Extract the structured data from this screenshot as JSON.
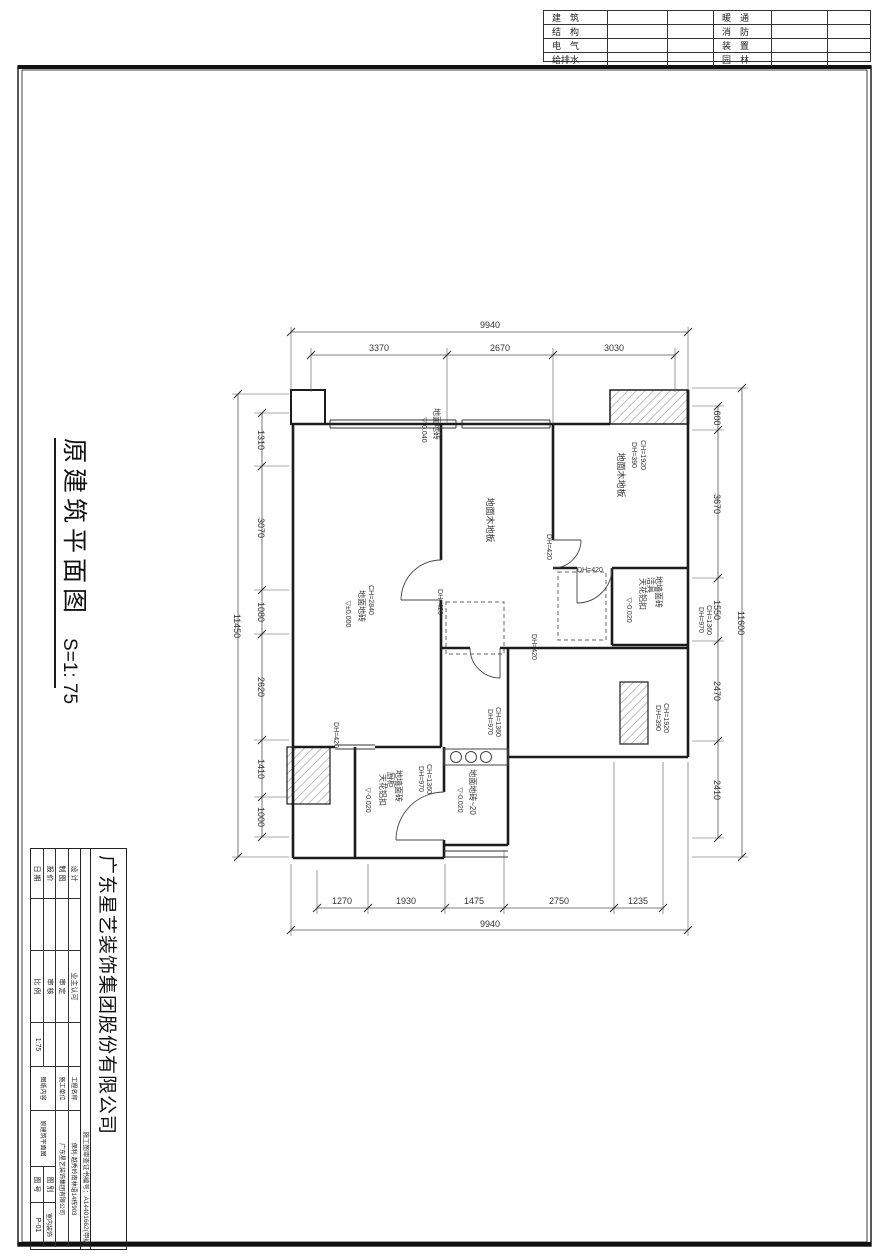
{
  "sheet_title": {
    "name": "原建筑平面图",
    "scale": "S=1: 75"
  },
  "discipline_table": {
    "rows": [
      {
        "left": "建　筑",
        "right": "暖　通"
      },
      {
        "left": "结　构",
        "right": "消　防"
      },
      {
        "left": "电　气",
        "right": "装　置"
      },
      {
        "left": "给排水",
        "right": "园　林"
      }
    ]
  },
  "title_block": {
    "company": "广东星艺装饰集团股份有限公司",
    "cert_no": "施工图审查证书编号：A14401662(甲级)",
    "approval": {
      "design_label": "设 计",
      "draft_label": "制 图",
      "quote_label": "报 价",
      "date_label": "日 期",
      "owner_label": "业主认可",
      "approve_label": "审 定",
      "review_label": "审 核",
      "scale_label": "比 例",
      "scale_value": "1:75"
    },
    "project": {
      "name_label": "工程名称",
      "name_value": "保利·越秀岭南林语14栋903",
      "builder_label": "施工单位",
      "builder_value": "广东星艺装饰集团有限公司",
      "content_label": "图纸内容",
      "content_value": "原建筑平面图",
      "category_label": "图 别",
      "category_value": "室内装饰",
      "number_label": "图 号",
      "number_value": "P-01"
    }
  },
  "plan": {
    "dim_texts": [
      {
        "t": "9940",
        "x": 490,
        "y": 328,
        "r": 0,
        "s": 9,
        "n": "dim-top-total"
      },
      {
        "t": "3370",
        "x": 379,
        "y": 351,
        "r": 0,
        "s": 9,
        "n": "dim-top"
      },
      {
        "t": "2670",
        "x": 500,
        "y": 351,
        "r": 0,
        "s": 9,
        "n": "dim-top"
      },
      {
        "t": "3030",
        "x": 614,
        "y": 351,
        "r": 0,
        "s": 9,
        "n": "dim-top"
      },
      {
        "t": "1270",
        "x": 342,
        "y": 904,
        "r": 0,
        "s": 9,
        "n": "dim-bottom"
      },
      {
        "t": "1930",
        "x": 406,
        "y": 904,
        "r": 0,
        "s": 9,
        "n": "dim-bottom"
      },
      {
        "t": "1475",
        "x": 474,
        "y": 904,
        "r": 0,
        "s": 9,
        "n": "dim-bottom"
      },
      {
        "t": "2750",
        "x": 559,
        "y": 904,
        "r": 0,
        "s": 9,
        "n": "dim-bottom"
      },
      {
        "t": "1235",
        "x": 638,
        "y": 904,
        "r": 0,
        "s": 9,
        "n": "dim-bottom"
      },
      {
        "t": "9940",
        "x": 490,
        "y": 927,
        "r": 0,
        "s": 9,
        "n": "dim-bottom-total"
      },
      {
        "t": "1310",
        "x": 258,
        "y": 440,
        "r": 90,
        "s": 9,
        "n": "dim-left"
      },
      {
        "t": "3070",
        "x": 258,
        "y": 528,
        "r": 90,
        "s": 9,
        "n": "dim-left"
      },
      {
        "t": "1080",
        "x": 258,
        "y": 612,
        "r": 90,
        "s": 9,
        "n": "dim-left"
      },
      {
        "t": "2620",
        "x": 258,
        "y": 687,
        "r": 90,
        "s": 9,
        "n": "dim-left"
      },
      {
        "t": "1410",
        "x": 258,
        "y": 769,
        "r": 90,
        "s": 9,
        "n": "dim-left"
      },
      {
        "t": "1000",
        "x": 258,
        "y": 817,
        "r": 90,
        "s": 9,
        "n": "dim-left"
      },
      {
        "t": "11450",
        "x": 234,
        "y": 626,
        "r": 90,
        "s": 9,
        "n": "dim-left-total"
      },
      {
        "t": "600",
        "x": 714,
        "y": 418,
        "r": 90,
        "s": 9,
        "n": "dim-right"
      },
      {
        "t": "3670",
        "x": 714,
        "y": 504,
        "r": 90,
        "s": 9,
        "n": "dim-right"
      },
      {
        "t": "1550",
        "x": 714,
        "y": 610,
        "r": 90,
        "s": 9,
        "n": "dim-right"
      },
      {
        "t": "2470",
        "x": 714,
        "y": 691,
        "r": 90,
        "s": 9,
        "n": "dim-right"
      },
      {
        "t": "2410",
        "x": 714,
        "y": 790,
        "r": 90,
        "s": 9,
        "n": "dim-right"
      },
      {
        "t": "11600",
        "x": 738,
        "y": 623,
        "r": 90,
        "s": 9,
        "n": "dim-right-total"
      },
      {
        "t": "DH=970",
        "x": 699,
        "y": 620,
        "r": 90,
        "s": 7,
        "n": "height-note"
      },
      {
        "t": "CH=1360",
        "x": 707,
        "y": 620,
        "r": 90,
        "s": 7,
        "n": "height-note"
      }
    ],
    "labels": [
      {
        "t": "地面地砖",
        "x": 434,
        "y": 424,
        "r": 90,
        "s": 8,
        "n": "room-finish-label"
      },
      {
        "t": "▽-0.040",
        "x": 422,
        "y": 430,
        "r": 90,
        "s": 7,
        "n": "level-mark"
      },
      {
        "t": "地面木地板",
        "x": 487,
        "y": 520,
        "r": 90,
        "s": 9,
        "n": "room-finish-label"
      },
      {
        "t": "地面木地板",
        "x": 618,
        "y": 475,
        "r": 90,
        "s": 9,
        "n": "room-finish-label"
      },
      {
        "t": "DH=390",
        "x": 632,
        "y": 455,
        "r": 90,
        "s": 7,
        "n": "height-note"
      },
      {
        "t": "CH=1920",
        "x": 641,
        "y": 455,
        "r": 90,
        "s": 7,
        "n": "height-note"
      },
      {
        "t": "CH=2840",
        "x": 369,
        "y": 600,
        "r": 90,
        "s": 7,
        "n": "height-note"
      },
      {
        "t": "地面地砖",
        "x": 359,
        "y": 606,
        "r": 90,
        "s": 8,
        "n": "room-finish-label"
      },
      {
        "t": "▽±0.000",
        "x": 346,
        "y": 614,
        "r": 90,
        "s": 7,
        "n": "level-mark"
      },
      {
        "t": "地墙面砖",
        "x": 656,
        "y": 592,
        "r": 90,
        "s": 8,
        "n": "room-finish-label"
      },
      {
        "t": "洁具",
        "x": 648,
        "y": 585,
        "r": 90,
        "s": 8,
        "n": "room-finish-label"
      },
      {
        "t": "天花铝扣",
        "x": 640,
        "y": 594,
        "r": 90,
        "s": 8,
        "n": "room-finish-label"
      },
      {
        "t": "▽-0.020",
        "x": 627,
        "y": 610,
        "r": 90,
        "s": 7,
        "n": "level-mark"
      },
      {
        "t": "DH=970",
        "x": 488,
        "y": 722,
        "r": 90,
        "s": 7,
        "n": "height-note"
      },
      {
        "t": "CH=1360",
        "x": 496,
        "y": 722,
        "r": 90,
        "s": 7,
        "n": "height-note"
      },
      {
        "t": "DH=390",
        "x": 656,
        "y": 718,
        "r": 90,
        "s": 7,
        "n": "height-note"
      },
      {
        "t": "CH=1920",
        "x": 664,
        "y": 718,
        "r": 90,
        "s": 7,
        "n": "height-note"
      },
      {
        "t": "地墙面砖",
        "x": 396,
        "y": 786,
        "r": 90,
        "s": 8,
        "n": "room-finish-label"
      },
      {
        "t": "厨柜",
        "x": 388,
        "y": 780,
        "r": 90,
        "s": 8,
        "n": "room-finish-label"
      },
      {
        "t": "天花铝扣",
        "x": 380,
        "y": 790,
        "r": 90,
        "s": 8,
        "n": "room-finish-label"
      },
      {
        "t": "▽-0.020",
        "x": 366,
        "y": 800,
        "r": 90,
        "s": 7,
        "n": "level-mark"
      },
      {
        "t": "DH=970",
        "x": 419,
        "y": 779,
        "r": 90,
        "s": 7,
        "n": "height-note"
      },
      {
        "t": "CH=1360",
        "x": 427,
        "y": 779,
        "r": 90,
        "s": 7,
        "n": "height-note"
      },
      {
        "t": "地面地砖~20",
        "x": 470,
        "y": 792,
        "r": 90,
        "s": 8,
        "n": "room-finish-label"
      },
      {
        "t": "▽-0.020",
        "x": 458,
        "y": 800,
        "r": 90,
        "s": 7,
        "n": "level-mark"
      },
      {
        "t": "DH=420",
        "x": 438,
        "y": 602,
        "r": 90,
        "s": 7,
        "n": "height-note"
      },
      {
        "t": "DH=420",
        "x": 547,
        "y": 547,
        "r": 90,
        "s": 7,
        "n": "height-note"
      },
      {
        "t": "DH=420",
        "x": 590,
        "y": 572,
        "r": 0,
        "s": 7,
        "n": "height-note"
      },
      {
        "t": "DH=420",
        "x": 532,
        "y": 647,
        "r": 90,
        "s": 7,
        "n": "height-note"
      },
      {
        "t": "DH=420",
        "x": 334,
        "y": 735,
        "r": 90,
        "s": 7,
        "n": "height-note"
      }
    ],
    "ticks": [
      [
        291,
        332
      ],
      [
        688,
        332
      ],
      [
        311,
        355
      ],
      [
        447,
        355
      ],
      [
        553,
        355
      ],
      [
        675,
        355
      ],
      [
        317,
        908
      ],
      [
        368,
        908
      ],
      [
        445,
        908
      ],
      [
        504,
        908
      ],
      [
        614,
        908
      ],
      [
        663,
        908
      ],
      [
        291,
        930
      ],
      [
        688,
        930
      ],
      [
        238,
        394
      ],
      [
        238,
        857
      ],
      [
        262,
        413
      ],
      [
        262,
        466
      ],
      [
        262,
        590
      ],
      [
        262,
        634
      ],
      [
        262,
        740
      ],
      [
        262,
        797
      ],
      [
        262,
        837
      ],
      [
        742,
        388
      ],
      [
        742,
        857
      ],
      [
        718,
        406
      ],
      [
        718,
        430
      ],
      [
        718,
        578
      ],
      [
        718,
        641
      ],
      [
        718,
        741
      ],
      [
        718,
        838
      ]
    ]
  }
}
